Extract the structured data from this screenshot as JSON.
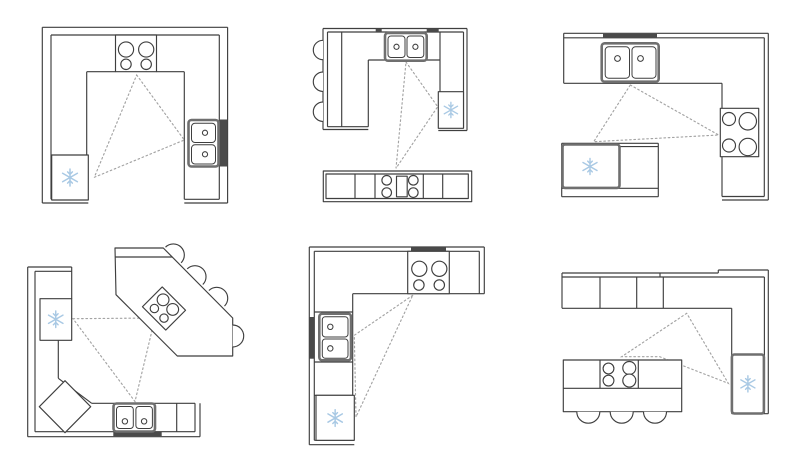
{
  "figure": {
    "grid": {
      "rows": 2,
      "cols": 3
    },
    "kind": "kitchen-floor-plan-layouts-with-work-triangles"
  },
  "colors": {
    "line": "#3f3f3f",
    "appliance_outline": "#6f6f6f",
    "work_triangle_dash": "#a3a3a3",
    "snowflake_blue": "#a9c9e4",
    "wall_accent": "#4a4a4a",
    "background": "#ffffff"
  },
  "icons": {
    "refrigerator": "snowflake",
    "sink": "double-basin-with-drains",
    "cooktop": "four-burner-circles",
    "seating": "semicircle-stool"
  },
  "diagrams": [
    {
      "name": "u-shape-kitchen",
      "appliances": [
        "cooktop",
        "double-sink",
        "refrigerator"
      ],
      "work_triangle": true,
      "seats": 0
    },
    {
      "name": "u-shape-with-island",
      "appliances": [
        "double-sink",
        "refrigerator",
        "island-cooktop"
      ],
      "work_triangle": true,
      "seats": 3
    },
    {
      "name": "l-shape-with-island",
      "appliances": [
        "double-sink",
        "cooktop",
        "island-refrigerator"
      ],
      "work_triangle": true,
      "seats": 0
    },
    {
      "name": "corner-kitchen-angled-bar",
      "appliances": [
        "refrigerator",
        "corner-cabinet",
        "double-sink",
        "bar-cooktop"
      ],
      "work_triangle": true,
      "seats": 4
    },
    {
      "name": "l-shape-kitchen",
      "appliances": [
        "cooktop",
        "double-sink",
        "refrigerator"
      ],
      "work_triangle": true,
      "seats": 0
    },
    {
      "name": "l-shape-with-breakfast-island",
      "appliances": [
        "cabinets",
        "island-cooktop",
        "refrigerator"
      ],
      "work_triangle": true,
      "seats": 3
    }
  ]
}
